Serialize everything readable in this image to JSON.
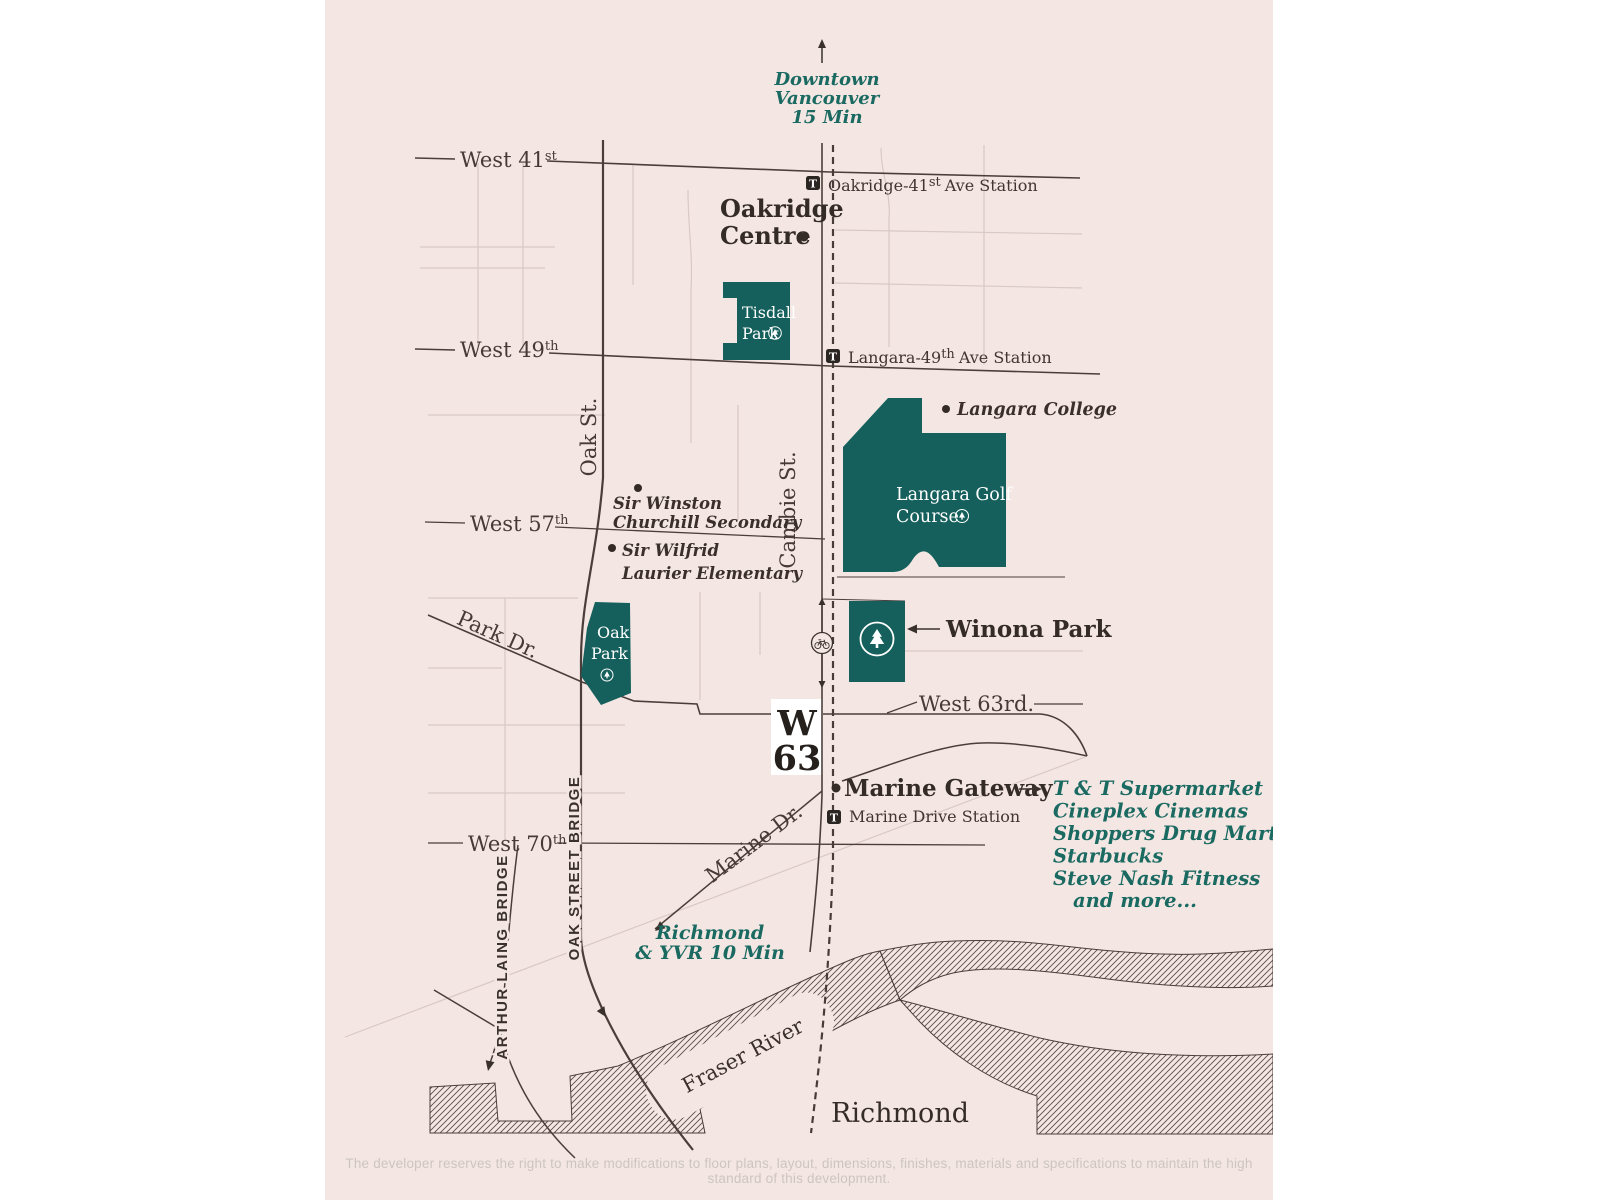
{
  "colors": {
    "background": "#f4e7e3",
    "park_fill": "#15605c",
    "teal_text": "#1b6a62",
    "dark_text": "#3a2f2b",
    "road_line": "#4b3e3a",
    "minor_line": "#d9c8c4",
    "disclaimer_text": "#cdc4c1",
    "logo_box": "#ffffff"
  },
  "directions": {
    "downtown": [
      "Downtown",
      "Vancouver",
      "15 Min"
    ],
    "richmond_yvr": [
      "Richmond",
      "& YVR 10 Min"
    ]
  },
  "streets": {
    "west41": {
      "name": "West 41",
      "sup": "st"
    },
    "west49": {
      "name": "West 49",
      "sup": "th"
    },
    "west57": {
      "name": "West 57",
      "sup": "th"
    },
    "west63": {
      "label": "West 63rd."
    },
    "west70": {
      "name": "West 70",
      "sup": "th"
    },
    "oak": "Oak St.",
    "cambie": "Cambie St.",
    "park_dr": "Park Dr.",
    "marine_dr": "Marine Dr.",
    "oak_bridge": "OAK STREET BRIDGE",
    "arthur_laing": "ARTHUR LAING BRIDGE"
  },
  "stations": {
    "icon": "T",
    "oakridge": {
      "pre": "Oakridge-41",
      "sup": "st",
      "post": "Ave Station"
    },
    "langara": {
      "pre": "Langara-49",
      "sup": "th",
      "post": "Ave Station"
    },
    "marine": {
      "label": "Marine Drive Station"
    }
  },
  "places": {
    "oakridge_centre": [
      "Oakridge",
      "Centre"
    ],
    "tisdall": [
      "Tisdall",
      "Park"
    ],
    "langara_college": "Langara College",
    "golf": [
      "Langara Golf",
      "Course"
    ],
    "oak_park": [
      "Oak",
      "Park"
    ],
    "winona": "Winona Park",
    "marine_gateway": "Marine Gateway",
    "richmond": "Richmond",
    "fraser": "Fraser River"
  },
  "amenities": [
    "T & T Supermarket",
    "Cineplex Cinemas",
    "Shoppers Drug Mart",
    "Starbucks",
    "Steve Nash Fitness",
    "and more..."
  ],
  "logo": {
    "line1": "W",
    "line2": "63"
  },
  "disclaimer": "The developer reserves the right to make modifications to floor plans, layout, dimensions, finishes, materials and specifications to maintain the high standard of this development."
}
